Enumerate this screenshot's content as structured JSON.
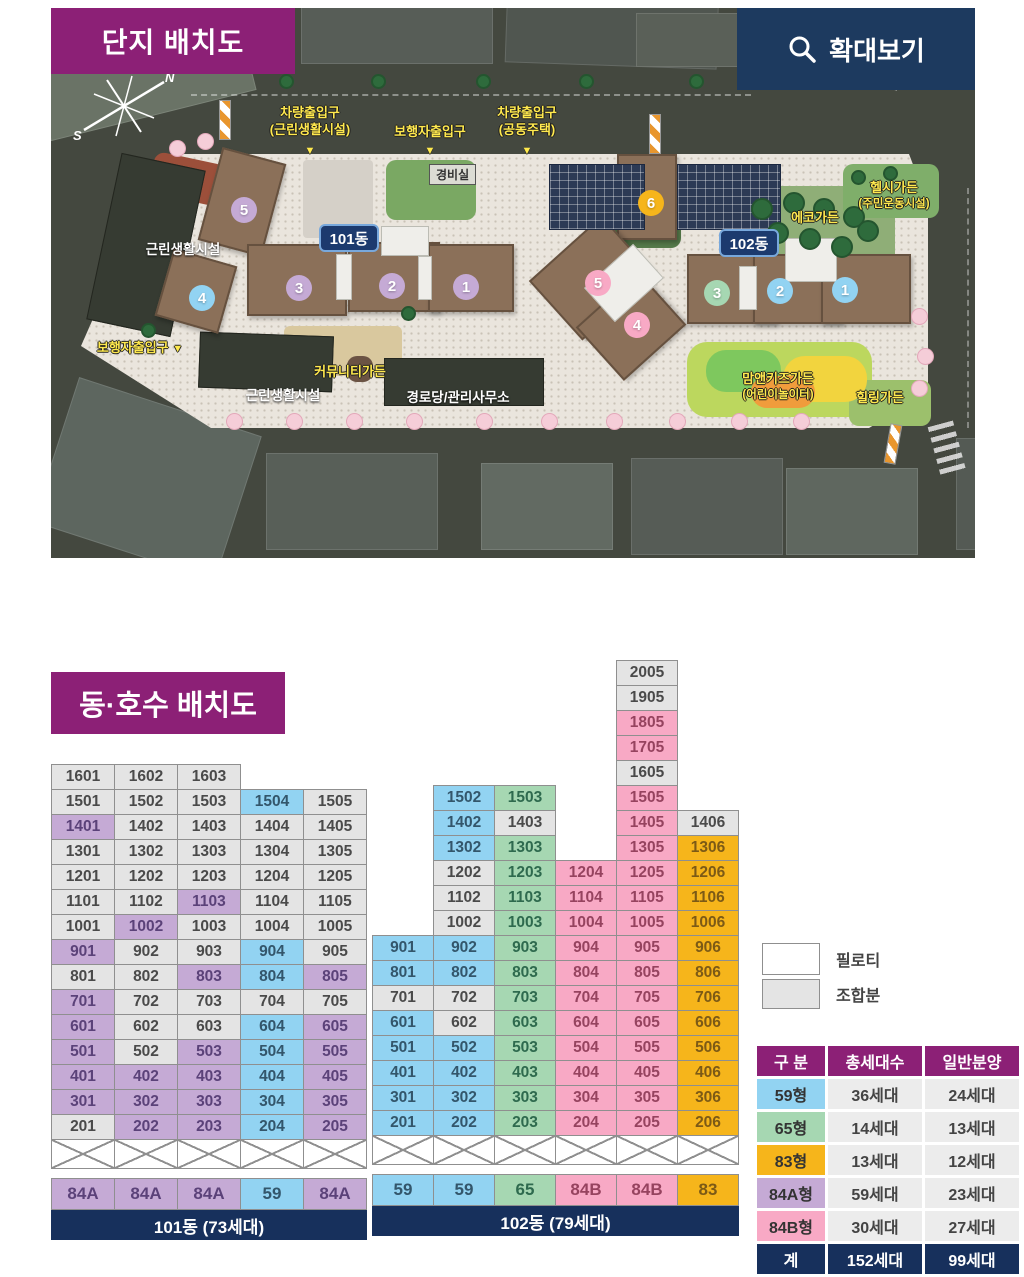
{
  "site_plan": {
    "title": "단지 배치도",
    "zoom_button_label": "확대보기",
    "compass": {
      "north": "N",
      "south": "S"
    },
    "badges": {
      "building_101": "101동",
      "building_102": "102동"
    },
    "labels": {
      "vehicle_entrance_retail_line1": "차량출입구",
      "vehicle_entrance_retail_line2": "(근린생활시설)",
      "pedestrian_entrance_top": "보행자출입구",
      "vehicle_entrance_housing_line1": "차량출입구",
      "vehicle_entrance_housing_line2": "(공동주택)",
      "guard_post": "경비실",
      "neighborhood_facility_upper": "근린생활시설",
      "neighborhood_facility_lower": "근린생활시설",
      "pedestrian_entrance_left": "보행자출입구",
      "community_garden": "커뮤니티가든",
      "senior_center_office": "경로당/관리사무소",
      "healthy_garden_line1": "헬시가든",
      "healthy_garden_line2": "(주민운동시설)",
      "eco_garden": "에코가든",
      "mom_kids_garden_line1": "맘앤키즈가든",
      "mom_kids_garden_line2": "(어린이놀이터)",
      "healing_garden": "힐링가든"
    },
    "entrance_marker": "▼",
    "building_101_markers": [
      {
        "no": "5",
        "type": "84A"
      },
      {
        "no": "4",
        "type": "59"
      },
      {
        "no": "3",
        "type": "84A"
      },
      {
        "no": "2",
        "type": "84A"
      },
      {
        "no": "1",
        "type": "84A"
      }
    ],
    "building_102_markers": [
      {
        "no": "6",
        "type": "83"
      },
      {
        "no": "5",
        "type": "84B"
      },
      {
        "no": "4",
        "type": "84B"
      },
      {
        "no": "3",
        "type": "65"
      },
      {
        "no": "2",
        "type": "59"
      },
      {
        "no": "1",
        "type": "59"
      }
    ]
  },
  "unit_layout": {
    "title": "동·호수 배치도",
    "legend": [
      {
        "key": "piloti",
        "label": "필로티"
      },
      {
        "key": "union",
        "label": "조합분"
      }
    ],
    "grids": {
      "building_101": {
        "name_footer": "101동 (73세대)",
        "piloti_cols": 5,
        "type_row": [
          "84A",
          "84A",
          "84A",
          "59",
          "84A"
        ],
        "floors": [
          [
            [
              "1601",
              "u"
            ],
            [
              "1602",
              "u"
            ],
            [
              "1603",
              "u"
            ],
            null,
            null
          ],
          [
            [
              "1501",
              "u"
            ],
            [
              "1502",
              "u"
            ],
            [
              "1503",
              "u"
            ],
            [
              "1504",
              "59"
            ],
            [
              "1505",
              "u"
            ]
          ],
          [
            [
              "1401",
              "84A"
            ],
            [
              "1402",
              "u"
            ],
            [
              "1403",
              "u"
            ],
            [
              "1404",
              "u"
            ],
            [
              "1405",
              "u"
            ]
          ],
          [
            [
              "1301",
              "u"
            ],
            [
              "1302",
              "u"
            ],
            [
              "1303",
              "u"
            ],
            [
              "1304",
              "u"
            ],
            [
              "1305",
              "u"
            ]
          ],
          [
            [
              "1201",
              "u"
            ],
            [
              "1202",
              "u"
            ],
            [
              "1203",
              "u"
            ],
            [
              "1204",
              "u"
            ],
            [
              "1205",
              "u"
            ]
          ],
          [
            [
              "1101",
              "u"
            ],
            [
              "1102",
              "u"
            ],
            [
              "1103",
              "84A"
            ],
            [
              "1104",
              "u"
            ],
            [
              "1105",
              "u"
            ]
          ],
          [
            [
              "1001",
              "u"
            ],
            [
              "1002",
              "84A"
            ],
            [
              "1003",
              "u"
            ],
            [
              "1004",
              "u"
            ],
            [
              "1005",
              "u"
            ]
          ],
          [
            [
              "901",
              "84A"
            ],
            [
              "902",
              "u"
            ],
            [
              "903",
              "u"
            ],
            [
              "904",
              "59"
            ],
            [
              "905",
              "u"
            ]
          ],
          [
            [
              "801",
              "u"
            ],
            [
              "802",
              "u"
            ],
            [
              "803",
              "84A"
            ],
            [
              "804",
              "59"
            ],
            [
              "805",
              "84A"
            ]
          ],
          [
            [
              "701",
              "84A"
            ],
            [
              "702",
              "u"
            ],
            [
              "703",
              "u"
            ],
            [
              "704",
              "u"
            ],
            [
              "705",
              "u"
            ]
          ],
          [
            [
              "601",
              "84A"
            ],
            [
              "602",
              "u"
            ],
            [
              "603",
              "u"
            ],
            [
              "604",
              "59"
            ],
            [
              "605",
              "84A"
            ]
          ],
          [
            [
              "501",
              "84A"
            ],
            [
              "502",
              "u"
            ],
            [
              "503",
              "84A"
            ],
            [
              "504",
              "59"
            ],
            [
              "505",
              "84A"
            ]
          ],
          [
            [
              "401",
              "84A"
            ],
            [
              "402",
              "84A"
            ],
            [
              "403",
              "84A"
            ],
            [
              "404",
              "59"
            ],
            [
              "405",
              "84A"
            ]
          ],
          [
            [
              "301",
              "84A"
            ],
            [
              "302",
              "84A"
            ],
            [
              "303",
              "84A"
            ],
            [
              "304",
              "59"
            ],
            [
              "305",
              "84A"
            ]
          ],
          [
            [
              "201",
              "u"
            ],
            [
              "202",
              "84A"
            ],
            [
              "203",
              "84A"
            ],
            [
              "204",
              "59"
            ],
            [
              "205",
              "84A"
            ]
          ]
        ]
      },
      "building_102": {
        "name_footer": "102동 (79세대)",
        "piloti_cols": 6,
        "type_row": [
          "59",
          "59",
          "65",
          "84B",
          "84B",
          "83"
        ],
        "floors": [
          [
            null,
            null,
            null,
            null,
            [
              "2005",
              "u"
            ],
            null
          ],
          [
            null,
            null,
            null,
            null,
            [
              "1905",
              "u"
            ],
            null
          ],
          [
            null,
            null,
            null,
            null,
            [
              "1805",
              "84B"
            ],
            null
          ],
          [
            null,
            null,
            null,
            null,
            [
              "1705",
              "84B"
            ],
            null
          ],
          [
            null,
            null,
            null,
            null,
            [
              "1605",
              "u"
            ],
            null
          ],
          [
            null,
            [
              "1502",
              "59"
            ],
            [
              "1503",
              "65"
            ],
            null,
            [
              "1505",
              "84B"
            ],
            null
          ],
          [
            null,
            [
              "1402",
              "59"
            ],
            [
              "1403",
              "u"
            ],
            null,
            [
              "1405",
              "84B"
            ],
            [
              "1406",
              "u"
            ]
          ],
          [
            null,
            [
              "1302",
              "59"
            ],
            [
              "1303",
              "65"
            ],
            null,
            [
              "1305",
              "84B"
            ],
            [
              "1306",
              "83"
            ]
          ],
          [
            null,
            [
              "1202",
              "u"
            ],
            [
              "1203",
              "65"
            ],
            [
              "1204",
              "84B"
            ],
            [
              "1205",
              "84B"
            ],
            [
              "1206",
              "83"
            ]
          ],
          [
            null,
            [
              "1102",
              "u"
            ],
            [
              "1103",
              "65"
            ],
            [
              "1104",
              "84B"
            ],
            [
              "1105",
              "84B"
            ],
            [
              "1106",
              "83"
            ]
          ],
          [
            null,
            [
              "1002",
              "u"
            ],
            [
              "1003",
              "65"
            ],
            [
              "1004",
              "84B"
            ],
            [
              "1005",
              "84B"
            ],
            [
              "1006",
              "83"
            ]
          ],
          [
            [
              "901",
              "59"
            ],
            [
              "902",
              "59"
            ],
            [
              "903",
              "65"
            ],
            [
              "904",
              "84B"
            ],
            [
              "905",
              "84B"
            ],
            [
              "906",
              "83"
            ]
          ],
          [
            [
              "801",
              "59"
            ],
            [
              "802",
              "59"
            ],
            [
              "803",
              "65"
            ],
            [
              "804",
              "84B"
            ],
            [
              "805",
              "84B"
            ],
            [
              "806",
              "83"
            ]
          ],
          [
            [
              "701",
              "u"
            ],
            [
              "702",
              "u"
            ],
            [
              "703",
              "65"
            ],
            [
              "704",
              "84B"
            ],
            [
              "705",
              "84B"
            ],
            [
              "706",
              "83"
            ]
          ],
          [
            [
              "601",
              "59"
            ],
            [
              "602",
              "u"
            ],
            [
              "603",
              "65"
            ],
            [
              "604",
              "84B"
            ],
            [
              "605",
              "84B"
            ],
            [
              "606",
              "83"
            ]
          ],
          [
            [
              "501",
              "59"
            ],
            [
              "502",
              "59"
            ],
            [
              "503",
              "65"
            ],
            [
              "504",
              "84B"
            ],
            [
              "505",
              "84B"
            ],
            [
              "506",
              "83"
            ]
          ],
          [
            [
              "401",
              "59"
            ],
            [
              "402",
              "59"
            ],
            [
              "403",
              "65"
            ],
            [
              "404",
              "84B"
            ],
            [
              "405",
              "84B"
            ],
            [
              "406",
              "83"
            ]
          ],
          [
            [
              "301",
              "59"
            ],
            [
              "302",
              "59"
            ],
            [
              "303",
              "65"
            ],
            [
              "304",
              "84B"
            ],
            [
              "305",
              "84B"
            ],
            [
              "306",
              "83"
            ]
          ],
          [
            [
              "201",
              "59"
            ],
            [
              "202",
              "59"
            ],
            [
              "203",
              "65"
            ],
            [
              "204",
              "84B"
            ],
            [
              "205",
              "84B"
            ],
            [
              "206",
              "83"
            ]
          ]
        ]
      }
    },
    "summary_table": {
      "headers": [
        "구 분",
        "총세대수",
        "일반분양"
      ],
      "rows": [
        {
          "type_label": "59형",
          "type_key": "59",
          "total": "36세대",
          "general": "24세대"
        },
        {
          "type_label": "65형",
          "type_key": "65",
          "total": "14세대",
          "general": "13세대"
        },
        {
          "type_label": "83형",
          "type_key": "83",
          "total": "13세대",
          "general": "12세대"
        },
        {
          "type_label": "84A형",
          "type_key": "84A",
          "total": "59세대",
          "general": "23세대"
        },
        {
          "type_label": "84B형",
          "type_key": "84B",
          "total": "30세대",
          "general": "27세대"
        }
      ],
      "total_row": {
        "type_label": "계",
        "total": "152세대",
        "general": "99세대"
      }
    }
  },
  "colors": {
    "type_59": "#92d3f2",
    "type_65": "#a6d7b2",
    "type_83": "#f6b51b",
    "type_84A": "#c5aad5",
    "type_84B": "#f8a9c5",
    "union_gray": "#e4e4e4",
    "title_purple": "#8c2076",
    "footer_navy": "#17305c",
    "button_navy": "#1d3a5f",
    "label_yellow": "#ffe94e"
  }
}
